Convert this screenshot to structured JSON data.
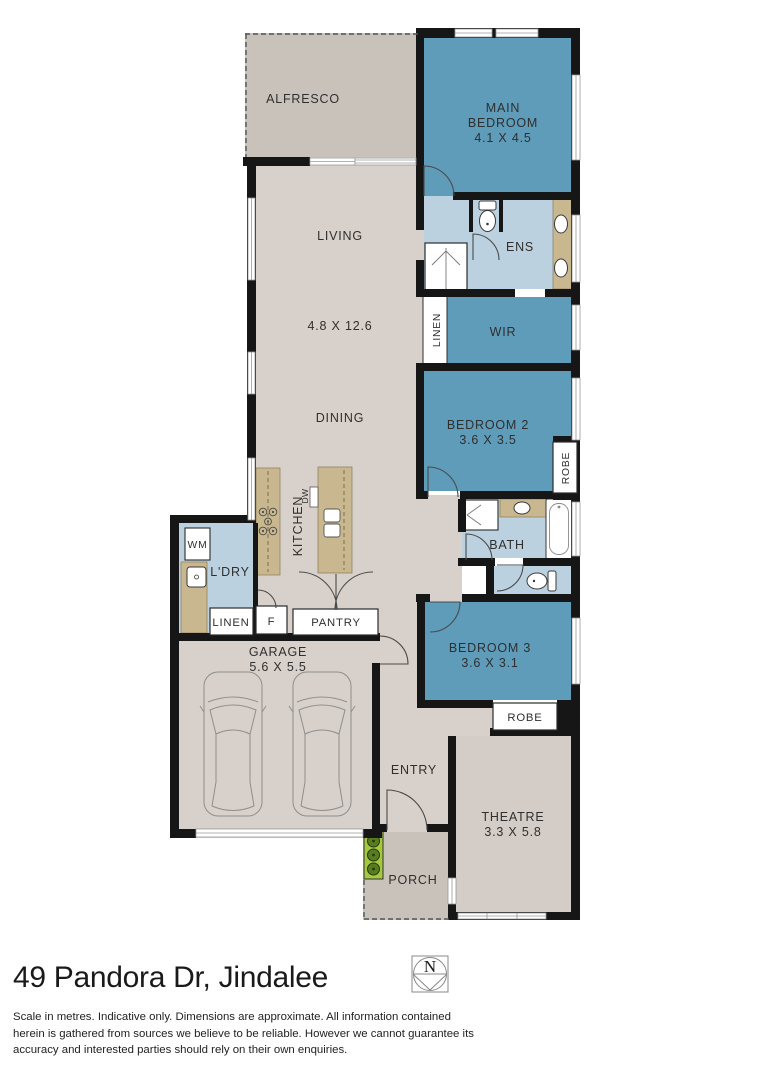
{
  "labels": {
    "alfresco": "ALFRESCO",
    "main_bedroom_line1": "MAIN",
    "main_bedroom_line2": "BEDROOM",
    "main_bedroom_dims": "4.1 X 4.5",
    "living": "LIVING",
    "living_dining_dims": "4.8 X 12.6",
    "dining": "DINING",
    "ens": "ENS",
    "wir": "WIR",
    "linen_hall": "LINEN",
    "bedroom2": "BEDROOM 2",
    "bedroom2_dims": "3.6 X 3.5",
    "robe_bedroom2": "ROBE",
    "bath": "BATH",
    "kitchen": "KITCHEN",
    "dishwasher": "DW",
    "washing_machine": "WM",
    "laundry": "L'DRY",
    "linen_laundry": "LINEN",
    "fridge": "F",
    "pantry": "PANTRY",
    "garage": "GARAGE",
    "garage_dims": "5.6 X 5.5",
    "bedroom3": "BEDROOM 3",
    "bedroom3_dims": "3.6 X 3.1",
    "robe_bedroom3": "ROBE",
    "entry": "ENTRY",
    "theatre": "THEATRE",
    "theatre_dims": "3.3 X 5.8",
    "porch": "PORCH"
  },
  "footer": {
    "address": "49 Pandora Dr, Jindalee",
    "compass_label": "N",
    "disclaimer_line1": "Scale in metres. Indicative only. Dimensions are approximate. All information contained",
    "disclaimer_line2": "herein is gathered from sources we believe to be reliable. However we cannot guarantee its",
    "disclaimer_line3": "accuracy and interested parties should rely on their own enquiries."
  },
  "colors": {
    "bedroom_blue": "#5f9cba",
    "wet_area_blue": "#bcd1e0",
    "floor_grey": "#d8d1cb",
    "outdoor_grey": "#c9c2bb",
    "theatre_grey": "#d4cdc7",
    "bench_tan": "#c9b78f",
    "wall_black": "#161616",
    "planter_green": "#a5c93c",
    "tree_green": "#597c1e"
  }
}
